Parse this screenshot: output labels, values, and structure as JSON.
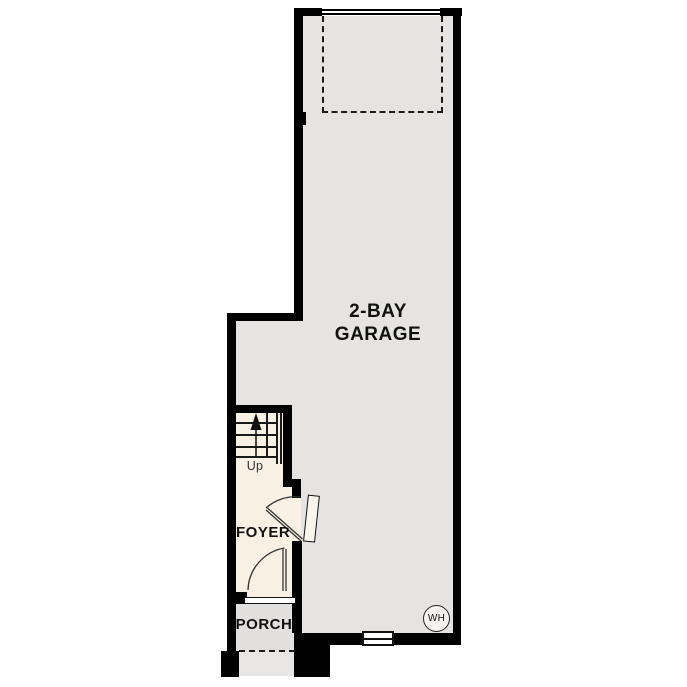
{
  "plan": {
    "rooms": {
      "garage": {
        "label_line1": "2-BAY",
        "label_line2": "GARAGE"
      },
      "foyer": {
        "label": "FOYER"
      },
      "porch": {
        "label": "PORCH"
      }
    },
    "stairs": {
      "direction_label": "Up"
    },
    "symbols": {
      "water_heater_label": "WH",
      "up_arrow": "up-arrow",
      "overhead_garage_door": "dashed-overhead-door-outline",
      "garage_entry_door": "door-swing-arc",
      "front_entry_door": "door-swing-arc",
      "window": "window-symbol",
      "entry_threshold": "threshold-step",
      "stair_railing": "double-line-railing"
    },
    "colors": {
      "wall": "#000000",
      "garage-floor": "#e5e4e2",
      "interior-floor": "#f8f1e4",
      "porch-floor": "#e1e0de",
      "step-floor": "#e8e7e5",
      "line": "#1a1a1a",
      "background": "#ffffff"
    }
  }
}
